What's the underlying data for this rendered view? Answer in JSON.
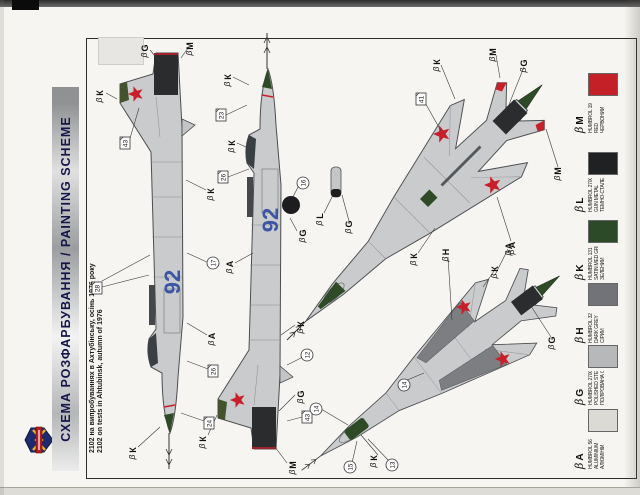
{
  "banner": {
    "title": "СХЕМА РОЗФАРБУВАННЯ  /  PAINTING SCHEME"
  },
  "caption": {
    "line1": "2102 на випробуваннях в Ахтубінську, осінь 1976 року",
    "line2": "2102 on tests in Ahtubinsk, autumn of 1976"
  },
  "aircraft": {
    "bort_number": "92"
  },
  "colors": {
    "airframe": "#c9cbcd",
    "outline": "#4b4d50",
    "star_red": "#c8202a",
    "bort_blue": "#3c55a5",
    "fin_green": "#45522e",
    "radome_green": "#2e4a26",
    "gunmetal": "#2b2c2e",
    "banner_text": "#15154a"
  },
  "legend": {
    "brush_glyph": "β",
    "entries": [
      {
        "letter": "A",
        "code": "HUMBROL 56",
        "name_en": "ALUMINIUM",
        "name_uk": "АЛЮМІНІЙ",
        "hex": "#dbdad5"
      },
      {
        "letter": "G",
        "code": "HUMBROL 27003",
        "name_en": "POLISHED STEEL",
        "name_uk": "ПОЛІРОВАНА СТАЛЬ",
        "hex": "#b7b8ba"
      },
      {
        "letter": "H",
        "code": "HUMBROL 32",
        "name_en": "DARK GREY",
        "name_uk": "СІРИЙ",
        "hex": "#717378"
      },
      {
        "letter": "K",
        "code": "HUMBROL 131",
        "name_en": "SATIN MED GREEN",
        "name_uk": "ЗЕЛЕНИЙ",
        "hex": "#2c4a28"
      },
      {
        "letter": "L",
        "code": "HUMBROL 27004",
        "name_en": "GUN METAL",
        "name_uk": "ТЕМНО-СТАЛЕВИЙ",
        "hex": "#202123"
      },
      {
        "letter": "M",
        "code": "HUMBROL 19",
        "name_en": "RED",
        "name_uk": "ЧЕРВОНИЙ",
        "hex": "#c32028"
      }
    ]
  },
  "callouts": {
    "letters": [
      {
        "t": "К"
      },
      {
        "t": "G"
      },
      {
        "t": "М"
      },
      {
        "t": "А"
      },
      {
        "t": "К"
      },
      {
        "t": "К"
      },
      {
        "t": "К"
      },
      {
        "t": "М"
      },
      {
        "t": "G"
      },
      {
        "t": "К"
      },
      {
        "t": "А"
      },
      {
        "t": "G"
      },
      {
        "t": "К"
      },
      {
        "t": "К"
      },
      {
        "t": "К"
      },
      {
        "t": "М"
      },
      {
        "t": "М"
      },
      {
        "t": "G"
      },
      {
        "t": "К"
      },
      {
        "t": "А"
      },
      {
        "t": "L"
      },
      {
        "t": "G"
      },
      {
        "t": "К"
      },
      {
        "t": "К"
      },
      {
        "t": "А"
      },
      {
        "t": "Н"
      },
      {
        "t": "G"
      }
    ],
    "squares": [
      {
        "n": "43"
      },
      {
        "n": "28"
      },
      {
        "n": "26"
      },
      {
        "n": "24"
      },
      {
        "n": "23"
      },
      {
        "n": "26"
      },
      {
        "n": "43"
      },
      {
        "n": "41"
      }
    ],
    "circles": [
      {
        "n": "17"
      },
      {
        "n": "16"
      },
      {
        "n": "12"
      },
      {
        "n": "14"
      },
      {
        "n": "14"
      },
      {
        "n": "15"
      },
      {
        "n": "13"
      }
    ]
  }
}
